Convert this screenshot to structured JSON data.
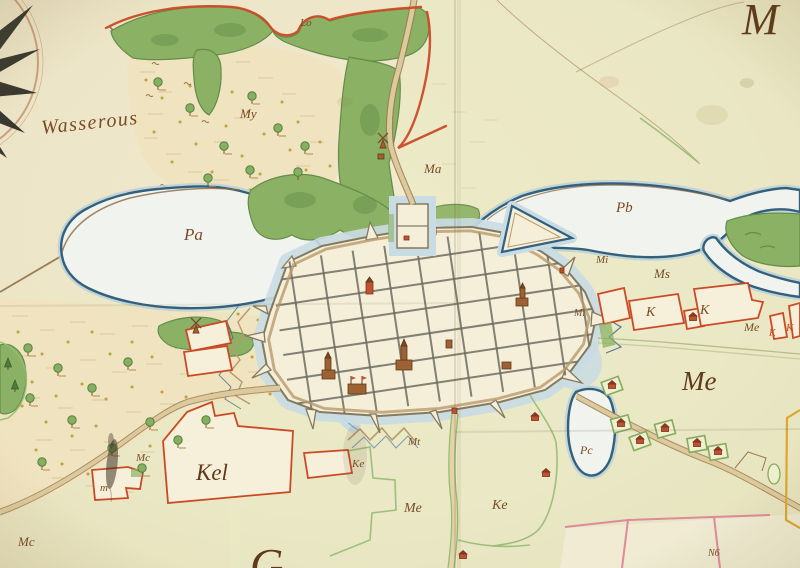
{
  "labels": {
    "wasserous": "Wasserous",
    "lo": "Lo",
    "my": "My",
    "ma": "Ma",
    "pa": "Pa",
    "pb": "Pb",
    "pc": "Pc",
    "mi1": "Mi",
    "mi2": "Mi",
    "ms": "Ms",
    "k1": "K",
    "k2": "K",
    "k3": "K",
    "k4": "K",
    "me1": "Me",
    "me2": "Me",
    "me3": "Me",
    "ke1": "Ke",
    "ke2": "Ke",
    "kel": "Kel",
    "mt": "Mt",
    "mc1": "Mc",
    "mc2": "Mc",
    "msmall": "m",
    "n6": "N6",
    "mbig": "M",
    "g": "G"
  },
  "palette": {
    "parchment": "#ece4c5",
    "parchment_light": "#f2ebcf",
    "parchment_dark": "#e2d7b2",
    "field": "#e8ebc3",
    "meadow": "#f0e3bf",
    "meadow_hatch": "#d9c69b",
    "dot": "#c2a23c",
    "water_fill": "#f1f4ee",
    "water_rim": "#b9cfd9",
    "water_edge": "#33607d",
    "shore_brown": "#8a6a42",
    "forest": "#8bb264",
    "forest_dark": "#648c49",
    "forest_light": "#a6c27c",
    "red_line": "#cb4a26",
    "pink_line": "#dd8a9a",
    "orange_line": "#dfa52f",
    "green_line": "#96bb74",
    "road_fill": "#dcc99e",
    "road_edge": "#9a7a4a",
    "street": "#6c6c60",
    "town_fill": "#f5efda",
    "wall_line": "#847a60",
    "rampart": "#b99a6a",
    "moat": "#c9dce3",
    "plot_fill": "#f6f0da",
    "building_brown": "#9c6234",
    "building_red": "#c0522e",
    "ink": "#7a4a26",
    "ink_dark": "#5d3a1a",
    "compass_black": "#2b2b24",
    "compass_ring": "#caa07c"
  },
  "icons": {
    "compass": "compass-rose",
    "windmill": "windmill-icon",
    "tree": "tree-icon",
    "fir": "fir-tree-icon",
    "house": "house-icon",
    "church": "church-icon"
  }
}
